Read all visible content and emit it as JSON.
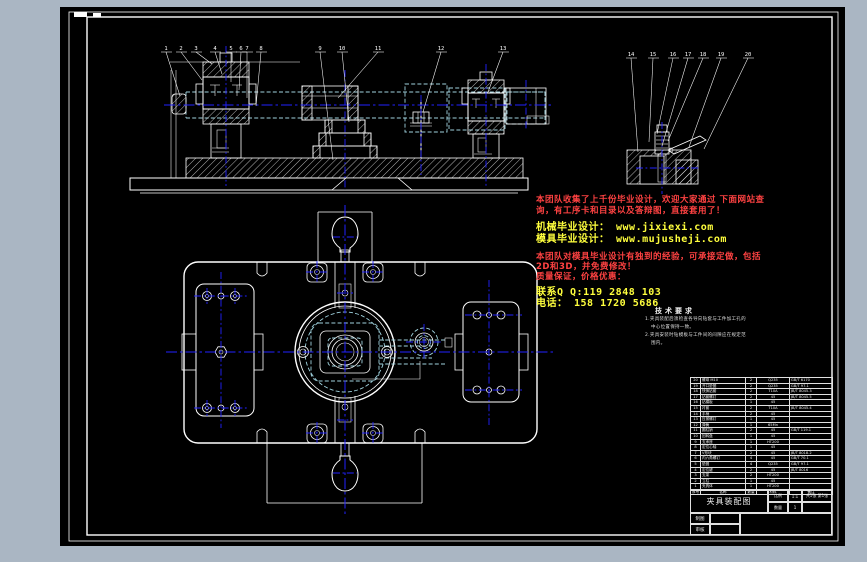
{
  "window": {
    "background": "#aab6c3",
    "canvas_background": "#000000"
  },
  "colors": {
    "line": "#ffffff",
    "centerline": "#2222ff",
    "hidden_line": "#9fd2de",
    "ad_red": "#ff4242",
    "ad_yellow": "#ffff3d"
  },
  "views": {
    "front_view": {
      "balloons": [
        "1",
        "2",
        "3",
        "4",
        "5",
        "6",
        "7",
        "8",
        "9",
        "10",
        "11",
        "12",
        "13"
      ]
    },
    "detail_view": {
      "balloons": [
        "14",
        "15",
        "16",
        "17",
        "18",
        "19",
        "20"
      ]
    }
  },
  "watermark": {
    "line1": "本团队收集了上千份毕业设计，欢迎大家通过 下面网站查",
    "line2": "询，有工序卡和目录以及答辩图，直接套用了！",
    "line3": "机械毕业设计： www.jixiexi.com",
    "line4": "模具毕业设计： www.mujusheji.com",
    "line5": "本团队对模具毕业设计有独到的经验，可承接定做，包括",
    "line6": "2D和3D，并免费修改！",
    "line7": "质量保证，价格优惠：",
    "line8": "联系Q Q:119 2848 103",
    "line9": "电话： 158 1720 5686"
  },
  "tech_requirements": {
    "title": "技术要求",
    "line1": "1.夹具装配后须检查各导向钻套与工件加工孔的",
    "line2": "中心位置保持一致。",
    "line3": "2.夹具安装时钻模板与工件间的间隙应在规定范",
    "line4": "围内。"
  },
  "bom": {
    "columns": [
      "序号",
      "名称",
      "数量",
      "材料",
      "备注"
    ],
    "rows": [
      {
        "no": "20",
        "name": "螺母 M10",
        "qty": "2",
        "material": "Q235",
        "standard": "GB/T 6170"
      },
      {
        "no": "19",
        "name": "开口垫圈",
        "qty": "2",
        "material": "Q235",
        "standard": "GB/T 97.1"
      },
      {
        "no": "18",
        "name": "快换钻套",
        "qty": "2",
        "material": "T10A",
        "standard": "JB/T 8045.3"
      },
      {
        "no": "17",
        "name": "钻套螺钉",
        "qty": "2",
        "material": "45",
        "standard": "JB/T 8045.5"
      },
      {
        "no": "16",
        "name": "钻模板",
        "qty": "1",
        "material": "45",
        "standard": ""
      },
      {
        "no": "15",
        "name": "衬套",
        "qty": "2",
        "material": "T10A",
        "standard": "JB/T 8045.4"
      },
      {
        "no": "14",
        "name": "手柄",
        "qty": "2",
        "material": "45",
        "standard": ""
      },
      {
        "no": "13",
        "name": "压紧螺钉",
        "qty": "1",
        "material": "45",
        "standard": ""
      },
      {
        "no": "12",
        "name": "弹簧",
        "qty": "1",
        "material": "65Mn",
        "standard": ""
      },
      {
        "no": "11",
        "name": "圆柱销",
        "qty": "2",
        "material": "45",
        "standard": "GB/T 119.1"
      },
      {
        "no": "10",
        "name": "回转盘",
        "qty": "1",
        "material": "45",
        "standard": ""
      },
      {
        "no": "9",
        "name": "支承座",
        "qty": "1",
        "material": "HT200",
        "standard": ""
      },
      {
        "no": "8",
        "name": "定位心轴",
        "qty": "1",
        "material": "45",
        "standard": ""
      },
      {
        "no": "7",
        "name": "V形块",
        "qty": "2",
        "material": "45",
        "standard": "JB/T 8018.2"
      },
      {
        "no": "6",
        "name": "内六角螺钉",
        "qty": "4",
        "material": "45",
        "standard": "GB/T 70.1"
      },
      {
        "no": "5",
        "name": "垫圈",
        "qty": "4",
        "material": "Q235",
        "standard": "GB/T 97.1"
      },
      {
        "no": "4",
        "name": "定位键",
        "qty": "2",
        "material": "45",
        "standard": "JB/T 8016"
      },
      {
        "no": "3",
        "name": "支架",
        "qty": "2",
        "material": "HT200",
        "standard": ""
      },
      {
        "no": "2",
        "name": "立柱",
        "qty": "1",
        "material": "45",
        "standard": ""
      },
      {
        "no": "1",
        "name": "夹具体",
        "qty": "1",
        "material": "HT200",
        "standard": ""
      }
    ]
  },
  "title_block": {
    "name": "夹具装配图",
    "scale_label": "比例",
    "scale": "1:1",
    "qty_label": "数量",
    "qty": "1",
    "sheet": "共1张 第1张",
    "drawn_label": "制图",
    "checked_label": "审核"
  }
}
